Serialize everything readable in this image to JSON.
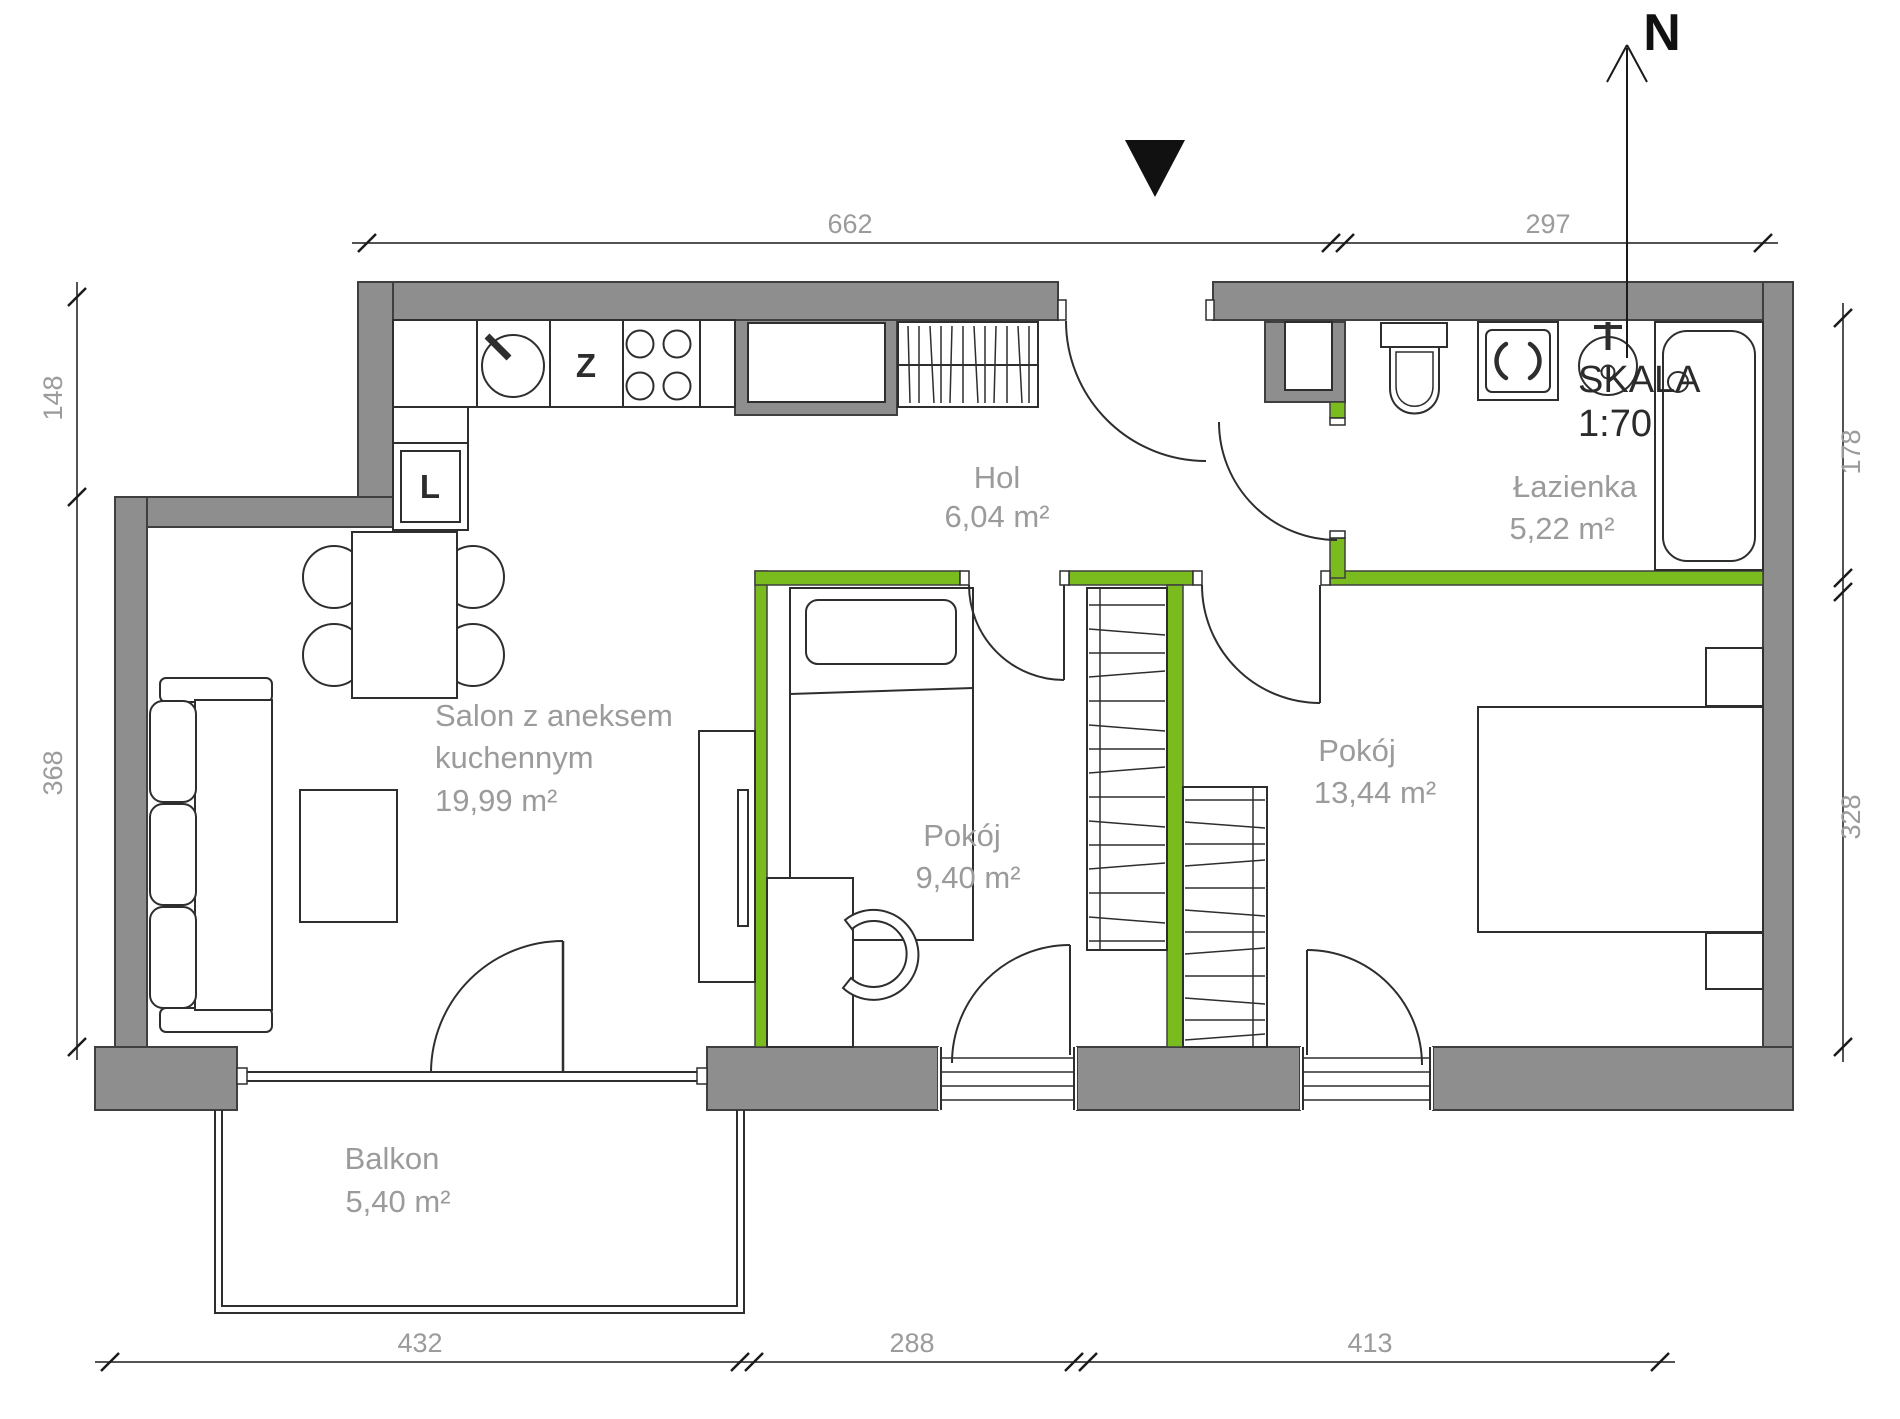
{
  "meta": {
    "north_label": "N",
    "scale_label": "SKALA",
    "scale_value": "1:70"
  },
  "rooms": [
    {
      "name": "Hol",
      "area": "6,04 m²"
    },
    {
      "name": "Łazienka",
      "area": "5,22 m²"
    },
    {
      "name": "Salon z aneksem kuchennym",
      "line1": "Salon z aneksem",
      "line2": "kuchennym",
      "area": "19,99 m²"
    },
    {
      "name": "Pokój",
      "area": "9,40 m²"
    },
    {
      "name": "Pokój",
      "area": "13,44 m²"
    },
    {
      "name": "Balkon",
      "area": "5,40 m²"
    }
  ],
  "dimensions": {
    "top": [
      "662",
      "297"
    ],
    "left": [
      "148",
      "368"
    ],
    "right": [
      "178",
      "328"
    ],
    "bottom": [
      "432",
      "288",
      "413"
    ]
  },
  "appliance_labels": {
    "dishwasher": "Z",
    "fridge": "L"
  },
  "colors": {
    "wall_gray": "#8e8e8e",
    "accent_green": "#7abb1d",
    "label_gray": "#9b9b9b",
    "line_dark": "#2e2e2e"
  }
}
